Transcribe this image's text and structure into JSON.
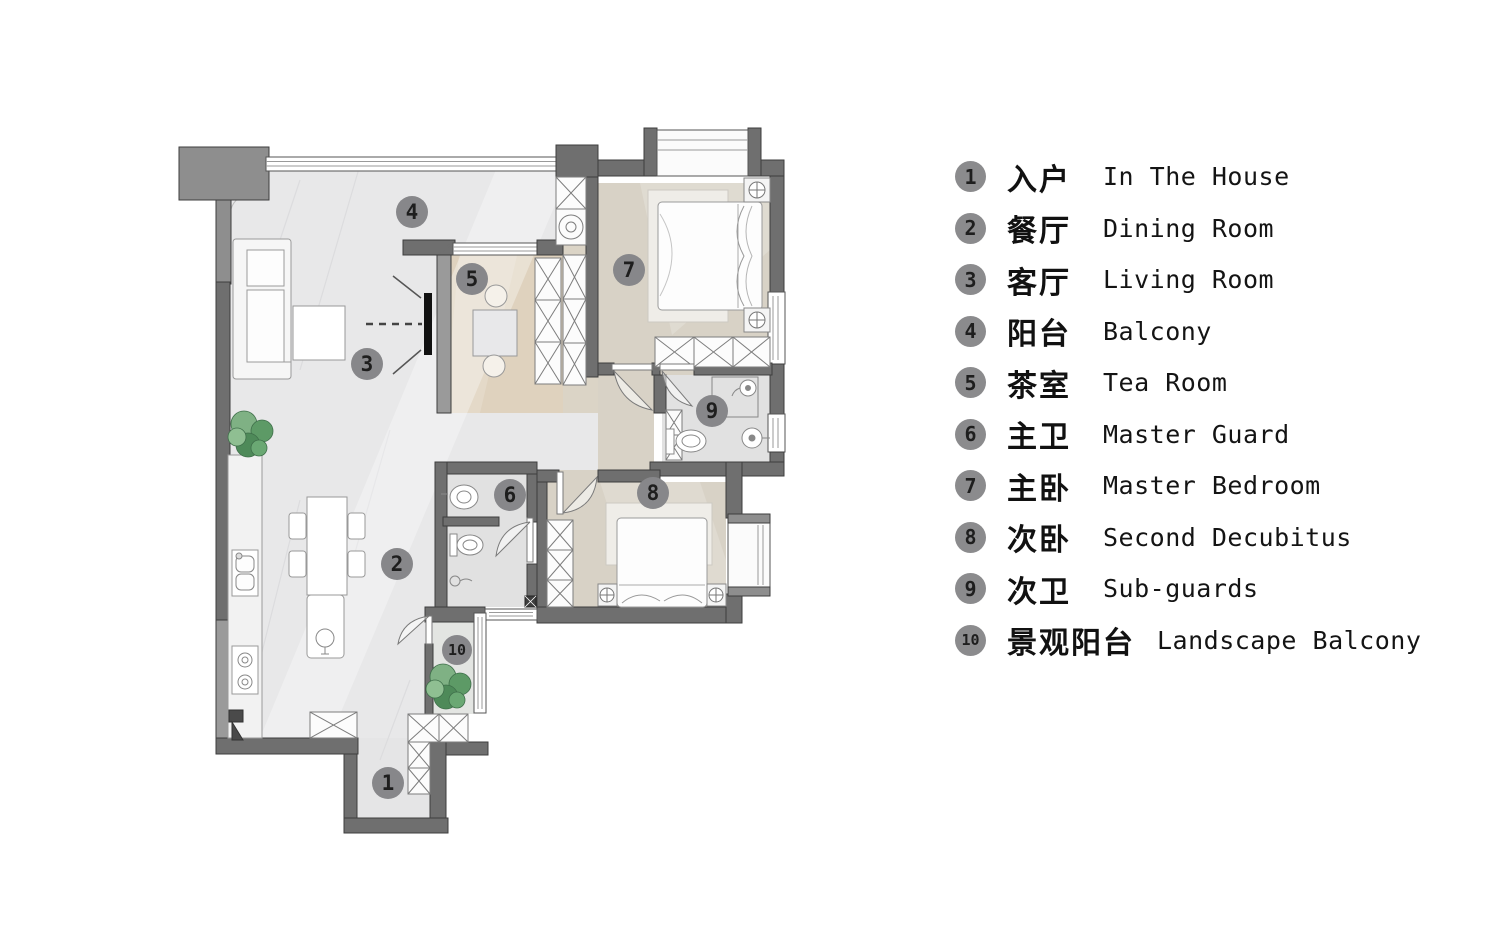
{
  "legend": {
    "items": [
      {
        "num": "1",
        "zh": "入户",
        "en": "In The House"
      },
      {
        "num": "2",
        "zh": "餐厅",
        "en": "Dining Room"
      },
      {
        "num": "3",
        "zh": "客厅",
        "en": "Living Room"
      },
      {
        "num": "4",
        "zh": "阳台",
        "en": "Balcony"
      },
      {
        "num": "5",
        "zh": "茶室",
        "en": "Tea Room"
      },
      {
        "num": "6",
        "zh": "主卫",
        "en": "Master Guard"
      },
      {
        "num": "7",
        "zh": "主卧",
        "en": "Master Bedroom"
      },
      {
        "num": "8",
        "zh": "次卧",
        "en": "Second Decubitus"
      },
      {
        "num": "9",
        "zh": "次卫",
        "en": "Sub-guards"
      },
      {
        "num": "10",
        "zh": "景观阳台",
        "en": "Landscape Balcony"
      }
    ]
  },
  "colors": {
    "wall": "#6f6f6f",
    "wall_light": "#8e8e8e",
    "floor_light": "#e8e8e9",
    "floor_warm": "#d8d2c6",
    "floor_tea": "#dfd2be",
    "floor_bath": "#e1e1e1",
    "bay_white": "#fbfbfb",
    "marker_bg": "#87878a",
    "plant_green": "#5d9a66",
    "tv_black": "#111111"
  }
}
